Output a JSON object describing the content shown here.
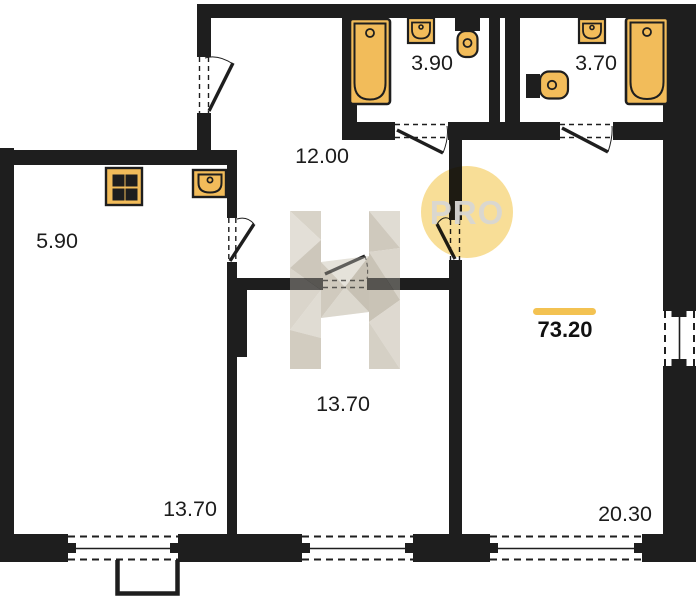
{
  "meta": {
    "type": "apartment-floor-plan"
  },
  "watermark": {
    "logo_letter": "H",
    "badge_text": "PRO"
  },
  "total_area": {
    "value": "73.20"
  },
  "rooms": [
    {
      "name": "kitchen-zone",
      "area": "5.90"
    },
    {
      "name": "hallway",
      "area": "12.00"
    },
    {
      "name": "bathroom-left",
      "area": "3.90"
    },
    {
      "name": "bathroom-right",
      "area": "3.70"
    },
    {
      "name": "room-middle",
      "area": "13.70"
    },
    {
      "name": "room-left",
      "area": "13.70"
    },
    {
      "name": "living-room",
      "area": "20.30"
    }
  ],
  "icons": [
    "stove-icon",
    "kitchen-sink-icon",
    "bathtub-icon",
    "washbasin-icon",
    "toilet-icon"
  ],
  "colors": {
    "wall": "#1e1e1e",
    "fixture_fill": "#f2bc5a",
    "accent_bar": "#f3c252",
    "watermark_circle": "#f8de97",
    "watermark_letter": "#d5d0c6"
  }
}
